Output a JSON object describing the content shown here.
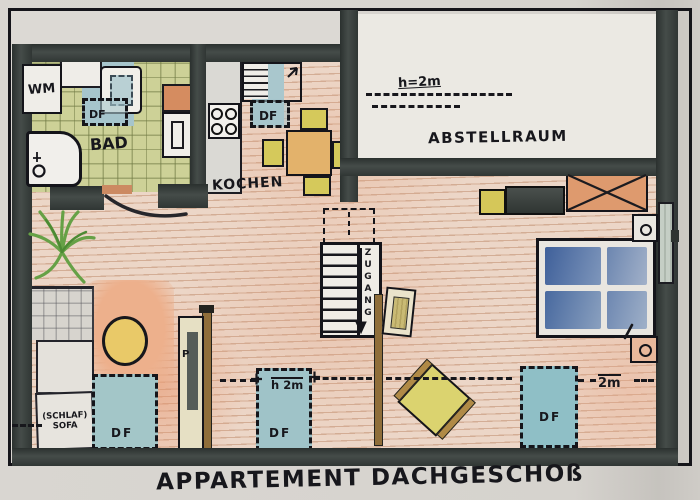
{
  "title": "APPARTEMENT DACHGESCHOß",
  "rooms": {
    "bathroom": {
      "name": "BAD",
      "washing_machine": "WM",
      "roof_window": "DF"
    },
    "kitchen": {
      "name": "KOCHEN",
      "roof_window": "DF"
    },
    "storage": {
      "name": "ABSTELLRAUM",
      "ceiling_height": "h=2m"
    },
    "living": {
      "stairs": "ZUGANG",
      "pillar_wardrobe": "P",
      "sofa_line1": "(SCHLAF)",
      "sofa_line2": "SOFA",
      "roof_window_left": "DF",
      "roof_window_mid": "DF",
      "roof_window_right": "DF",
      "ceiling_height_mid": "h 2m",
      "ceiling_height_right": "2m"
    }
  },
  "colors": {
    "wall": "#343a38",
    "floor_wood": "#e9d0c0",
    "tile_green": "#ccd197",
    "window_blue": "#9fc3c8",
    "accent_orange": "#de9a6e",
    "furniture_yellow": "#d6ca5b",
    "bed_blue": "#5d7ba8",
    "wood_beam": "#8f6e3a"
  }
}
